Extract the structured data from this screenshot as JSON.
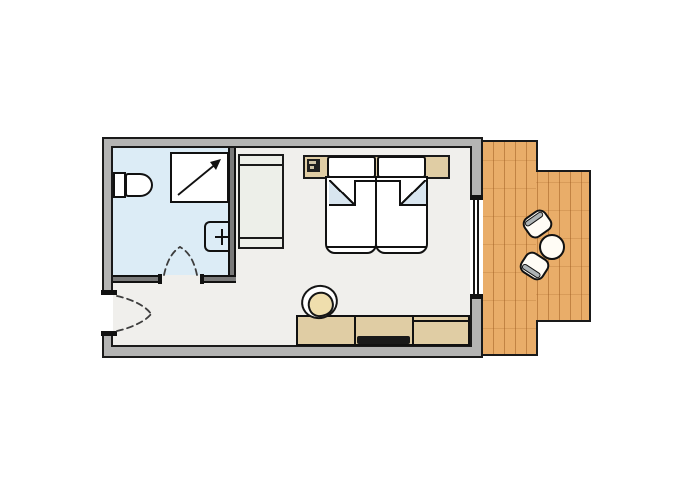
{
  "plan": {
    "type": "hotel-room-floor-plan",
    "rooms": [
      {
        "name": "bathroom",
        "floor": "light-blue tile"
      },
      {
        "name": "bedroom-living-area",
        "floor": "light neutral"
      },
      {
        "name": "balcony-terrace",
        "floor": "wood decking"
      }
    ],
    "fixtures": [
      "toilet",
      "shower-with-entry-arrow",
      "washbasin-with-tap",
      "bathroom-swing-door",
      "entry-swing-door",
      "window-sliding-door"
    ],
    "furniture": [
      "wardrobe",
      "headboard-console",
      "phone-on-console",
      "twin-bed-left",
      "twin-bed-right",
      "pillow-left",
      "pillow-right",
      "desk-sideboard",
      "tv",
      "desk-chair",
      "balcony-table",
      "balcony-chair-upper",
      "balcony-chair-lower"
    ]
  },
  "colors": {
    "wall": "#b4b4b3",
    "outline": "#1a1a1a",
    "room_floor": "#f0efec",
    "bathroom_floor": "#dcecf6",
    "partition": "#7a7a7a",
    "wood": "#e9ad69",
    "wood_line": "#9c5a1e",
    "wardrobe": "#edefe9",
    "furniture": "#e0cda4",
    "fold": "#d8e5ef",
    "cushion": "#efdead",
    "tv": "#191919",
    "chair_band": "#aeb4b6",
    "swing_dash": "#3d3d3d"
  }
}
